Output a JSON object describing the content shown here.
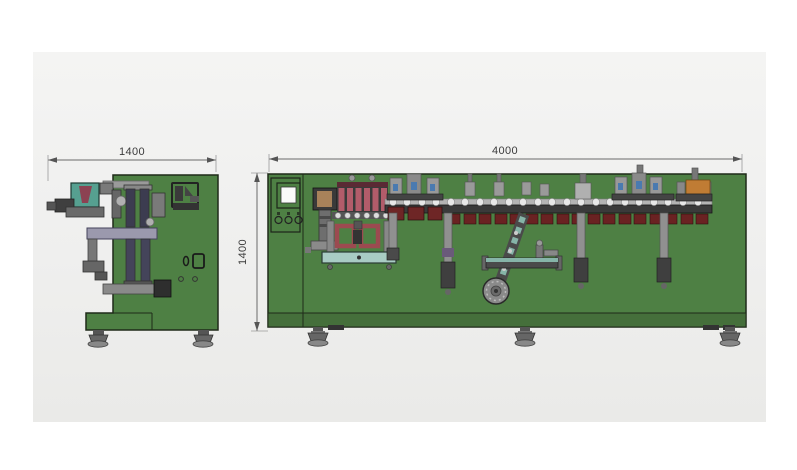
{
  "page": {
    "background": "#ffffff",
    "card_background": "#f1f1ef"
  },
  "drawing_title": "horizontal pouch packaging machine - dimension drawing",
  "dimensions": {
    "side_view_width": {
      "value": "1400",
      "unit": "mm"
    },
    "front_view_width": {
      "value": "4000",
      "unit": "mm"
    },
    "front_view_height": {
      "value": "1400",
      "unit": "mm"
    }
  },
  "palette": {
    "machine_green": "#4e8044",
    "machine_green_dark": "#456f3b",
    "outline": "#1f2a19",
    "roller_pink": "#b25c6a",
    "roller_cap": "#5a2a34",
    "pouch_red": "#6a2222",
    "teal_bar": "#a9ccc4",
    "conveyor_teal": "#86b4a8",
    "metal_light": "#b0b0b0",
    "metal_mid": "#8a8a8a",
    "metal_dark": "#4a4a4a",
    "accent_orange": "#c07c34",
    "accent_blue": "#4a7ab0",
    "accent_purple": "#9b99ad",
    "hopper_teal": "#56a090",
    "hopper_red": "#8c4252",
    "magazine_tan": "#a8825a",
    "screen_white": "#fafafa",
    "dimension_line": "#6a6a6a",
    "dimension_text": "#3b3b3b"
  }
}
